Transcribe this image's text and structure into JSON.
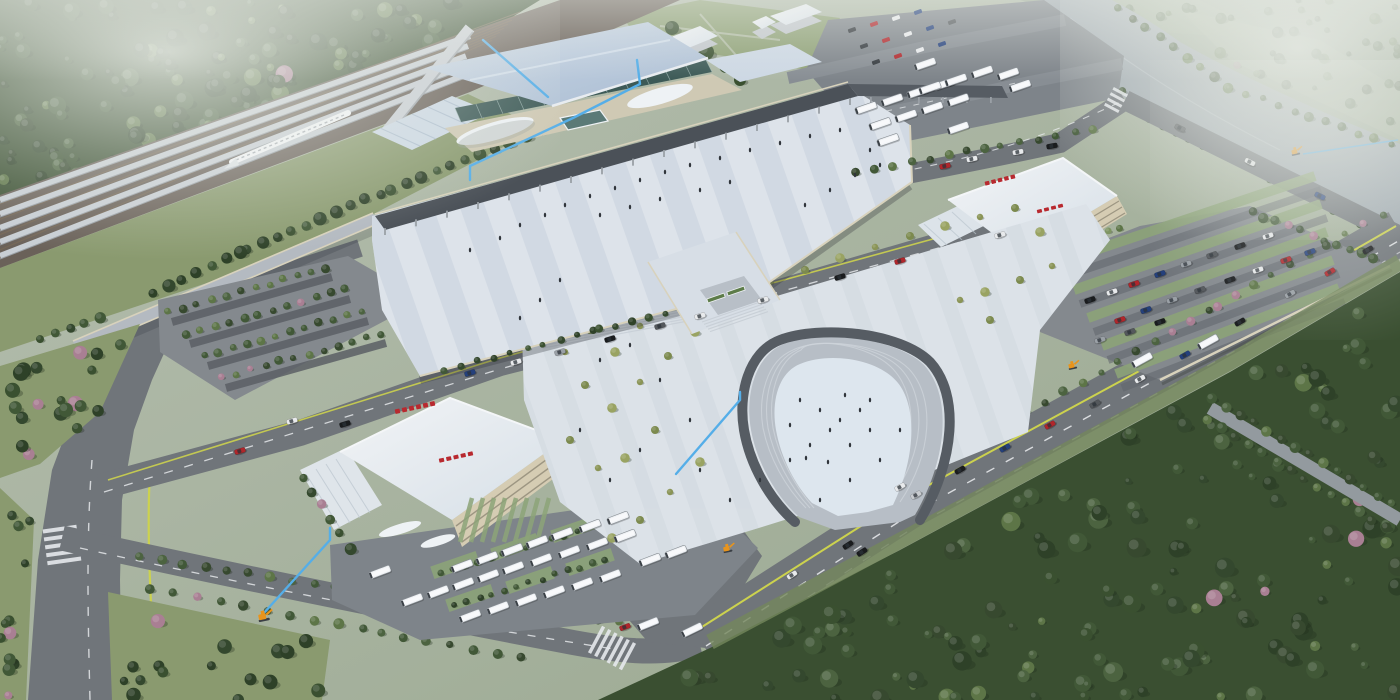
{
  "meta": {
    "kind": "architectural-aerial-rendering",
    "subject": "high-speed railway station complex masterplan",
    "view": "bird's-eye perspective, hazy daylight",
    "legible_text": false
  },
  "palette": {
    "haze": "#e6eae3",
    "distant": "#9aa894",
    "distant_light": "#aab5a0",
    "river": "#9fa9b0",
    "forest_base": "#3a4f31",
    "forest_dark": "#2e4128",
    "forest": "#415837",
    "foliage": "#5d7547",
    "foliage_light": "#7e9562",
    "blossom": "#a97f93",
    "grass": "#8a9a6f",
    "lawn": "#90a278",
    "verge": "#74875c",
    "road": "#70757a",
    "road_light": "#7e848a",
    "lane_yellow": "#ccd24e",
    "lane_white": "#eceff1",
    "curb": "#d8d2bc",
    "deck": "#dde3ea",
    "deck_stripe": "#c7d1dc",
    "plaza": "#dce2e8",
    "plaza_stripe": "#c9d2da",
    "canopy": "#4b5158",
    "station_roof": "#b5c4d7",
    "station_roof_light": "#cdd9e5",
    "glass": "#3d5a57",
    "facade": "#d5ccb3",
    "white_roof": "#eef1f4",
    "concrete": "#b4bac1",
    "column": "#9aa0a6",
    "sign_red": "#b8292f",
    "stall_green": "#8ca378",
    "stall_dark": "#5a5f65",
    "bus_white": "#eef1f4",
    "annotation_blue": "#55aee8",
    "marker_orange": "#e8941c",
    "people": "#30353b",
    "train_white": "#f4f6f8",
    "track": "#7a6a55",
    "ballast": "#6a6159",
    "steps_mid": "#b7bec6",
    "horseshoe_path": "#565c63",
    "horseshoe_inner": "#dde6ee"
  },
  "annotations": {
    "leader_line_color": "#55aee8",
    "leader_line_count": 5,
    "site_marker_color": "#e8941c",
    "site_marker_count": 4
  },
  "signage": {
    "style": "red block characters (illegible at this resolution)",
    "color": "#b8292f",
    "locations": [
      "bus-terminal roof edge",
      "bus-terminal facade",
      "parking-building roof edge",
      "parking-building facade"
    ]
  },
  "scene": {
    "areas": [
      "railway platforms with canopies and high-speed train",
      "station hall with glass facade and curved entrance canopies",
      "elevated striped pedestrian deck with long dark canopy",
      "approach ramp viaduct",
      "forecourt plaza with scattered trees",
      "horseshoe amphitheater with steps",
      "pedestrian bridge with escalator entrances",
      "bus terminal with angled bus parking",
      "parking building with surface car lot",
      "tree-lined car parking rows",
      "multi-lane boulevards with lane markings",
      "river with tree-lined banks",
      "dense forests and hazy distant landscape"
    ]
  },
  "vehicles": {
    "train": {
      "count": 1,
      "color": "#f4f6f8"
    },
    "buses": {
      "body_color": "#eef1f4"
    },
    "car_colors": [
      "#1a1c1e",
      "#e8eaec",
      "#b0262b",
      "#24407c",
      "#9aa0a6",
      "#54585c"
    ]
  }
}
